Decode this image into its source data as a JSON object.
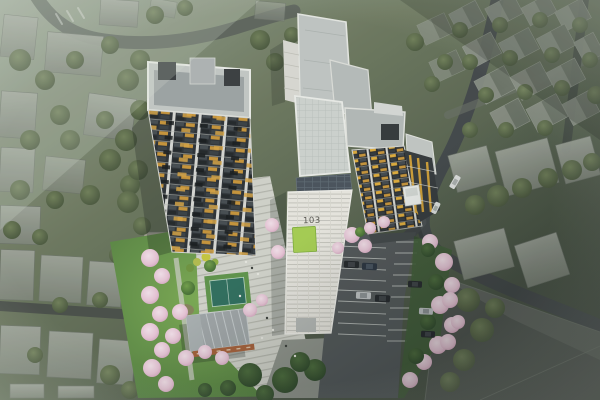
{
  "scene": {
    "type": "aerial-architectural-rendering",
    "title": "Apartment complex bird's-eye rendering",
    "description": "Dusk aerial view of high-rise residential towers with landscaped courtyard, sports court, cherry blossom trees, surface parking lot and surrounding hazy low-rise neighborhood"
  },
  "labels": {
    "tower_103": "103"
  },
  "colors": {
    "sign_green": "#a7cf53",
    "lit_window": "#c9953a",
    "facade_dark": "#2d3136",
    "facade_white": "#eae8e2",
    "blossom_pink": "#e9c6d8",
    "lawn_green": "#6fa04c",
    "asphalt": "#4b5053",
    "context_gray": "#8f958c"
  }
}
